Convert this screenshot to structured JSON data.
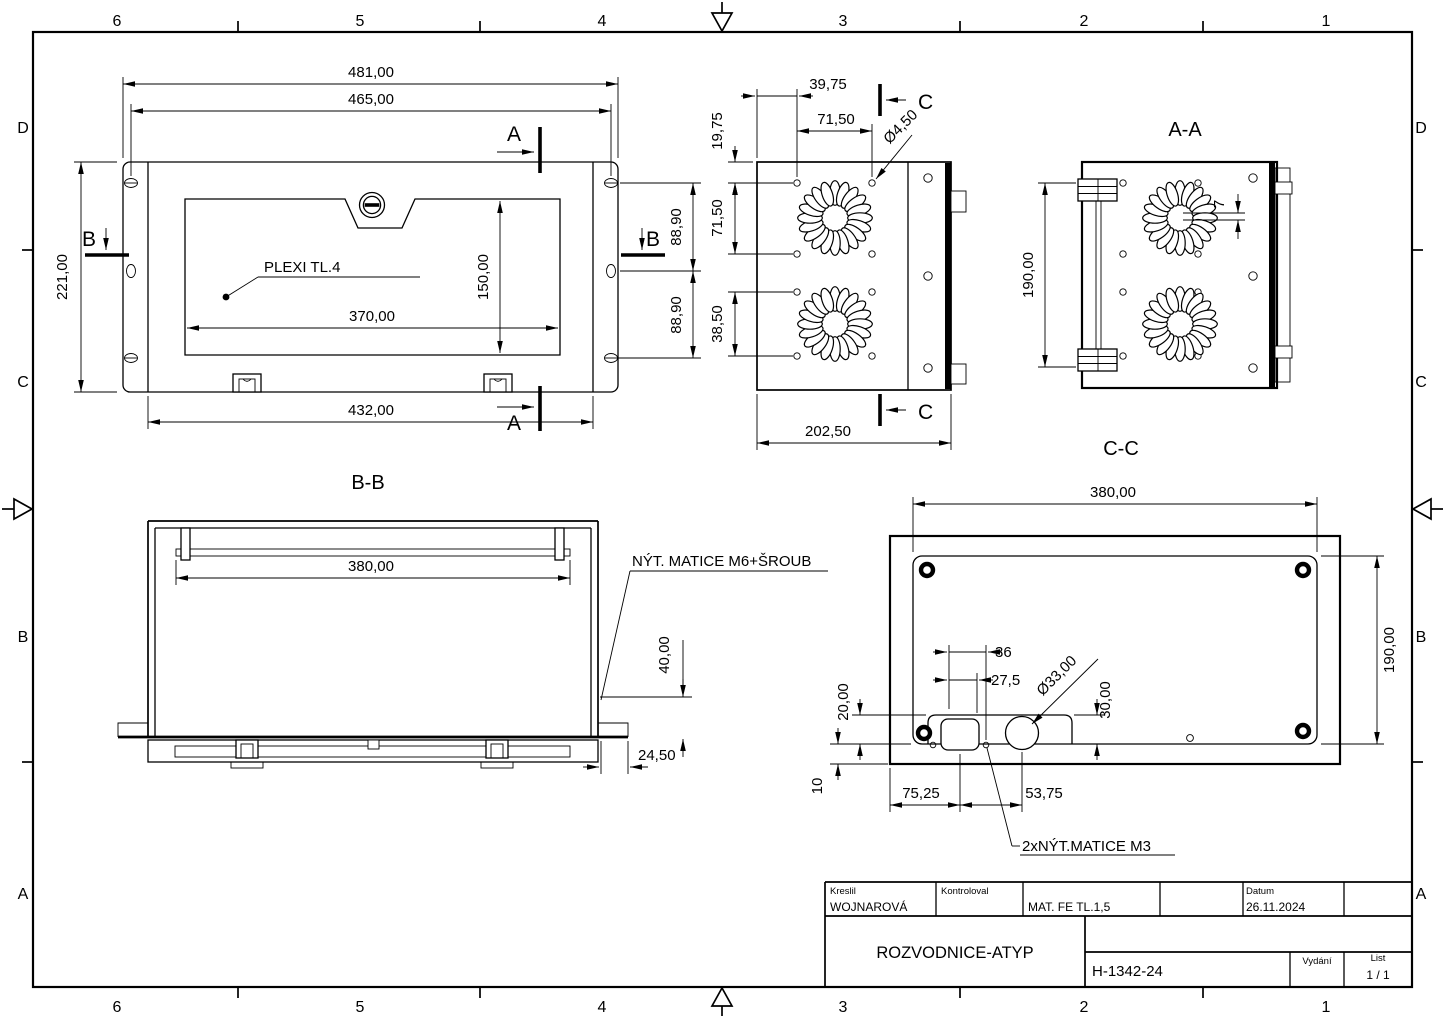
{
  "zones": {
    "top": [
      "6",
      "5",
      "4",
      "3",
      "2",
      "1"
    ],
    "bottom": [
      "6",
      "5",
      "4",
      "3",
      "2",
      "1"
    ],
    "left": [
      "D",
      "C",
      "B",
      "A"
    ],
    "right": [
      "D",
      "C",
      "B",
      "A"
    ]
  },
  "front": {
    "dim_width_outer": "481,00",
    "dim_width_holes": "465,00",
    "dim_height": "221,00",
    "dim_window_width": "370,00",
    "dim_window_height": "150,00",
    "dim_body_width": "432,00",
    "dim_pitch_upper": "88,90",
    "dim_pitch_lower": "88,90",
    "label_plexi": "PLEXI  TL.4",
    "section_a": "A",
    "section_b": "B"
  },
  "side": {
    "dim_edge_to_holes": "39,75",
    "dim_hole_span_h": "71,50",
    "dim_top_offset": "19,75",
    "dim_hole_span_v": "71,50",
    "dim_lower_span": "38,50",
    "dim_hole_dia": "Ø4,50",
    "dim_depth": "202,50",
    "section_c": "C"
  },
  "aa": {
    "title": "A-A",
    "dim_height": "190,00",
    "dim_gap": "7"
  },
  "bb": {
    "title": "B-B",
    "dim_rail_width": "380,00",
    "note_rivet": "NÝT. MATICE M6+ŠROUB",
    "dim_rivet_height": "40,00",
    "dim_flange": "24,50"
  },
  "cc": {
    "title": "C-C",
    "dim_width": "380,00",
    "dim_height": "190,00",
    "dim_36": "36",
    "dim_275": "27,5",
    "dim_hole_dia": "Ø33,00",
    "dim_30": "30,00",
    "dim_20": "20,00",
    "dim_10": "10",
    "dim_7525": "75,25",
    "dim_5375": "53,75",
    "note_rivet": "2xNÝT.MATICE M3"
  },
  "titleblock": {
    "kreslil_label": "Kreslil",
    "kreslil": "WOJNAROVÁ",
    "kontroloval_label": "Kontroloval",
    "mat": "MAT. FE  TL.1,5",
    "datum_label": "Datum",
    "datum": "26.11.2024",
    "title": "ROZVODNICE-ATYP",
    "doc_number": "H-1342-24",
    "vydani_label": "Vydání",
    "list_label": "List",
    "list_value": "1 / 1"
  }
}
